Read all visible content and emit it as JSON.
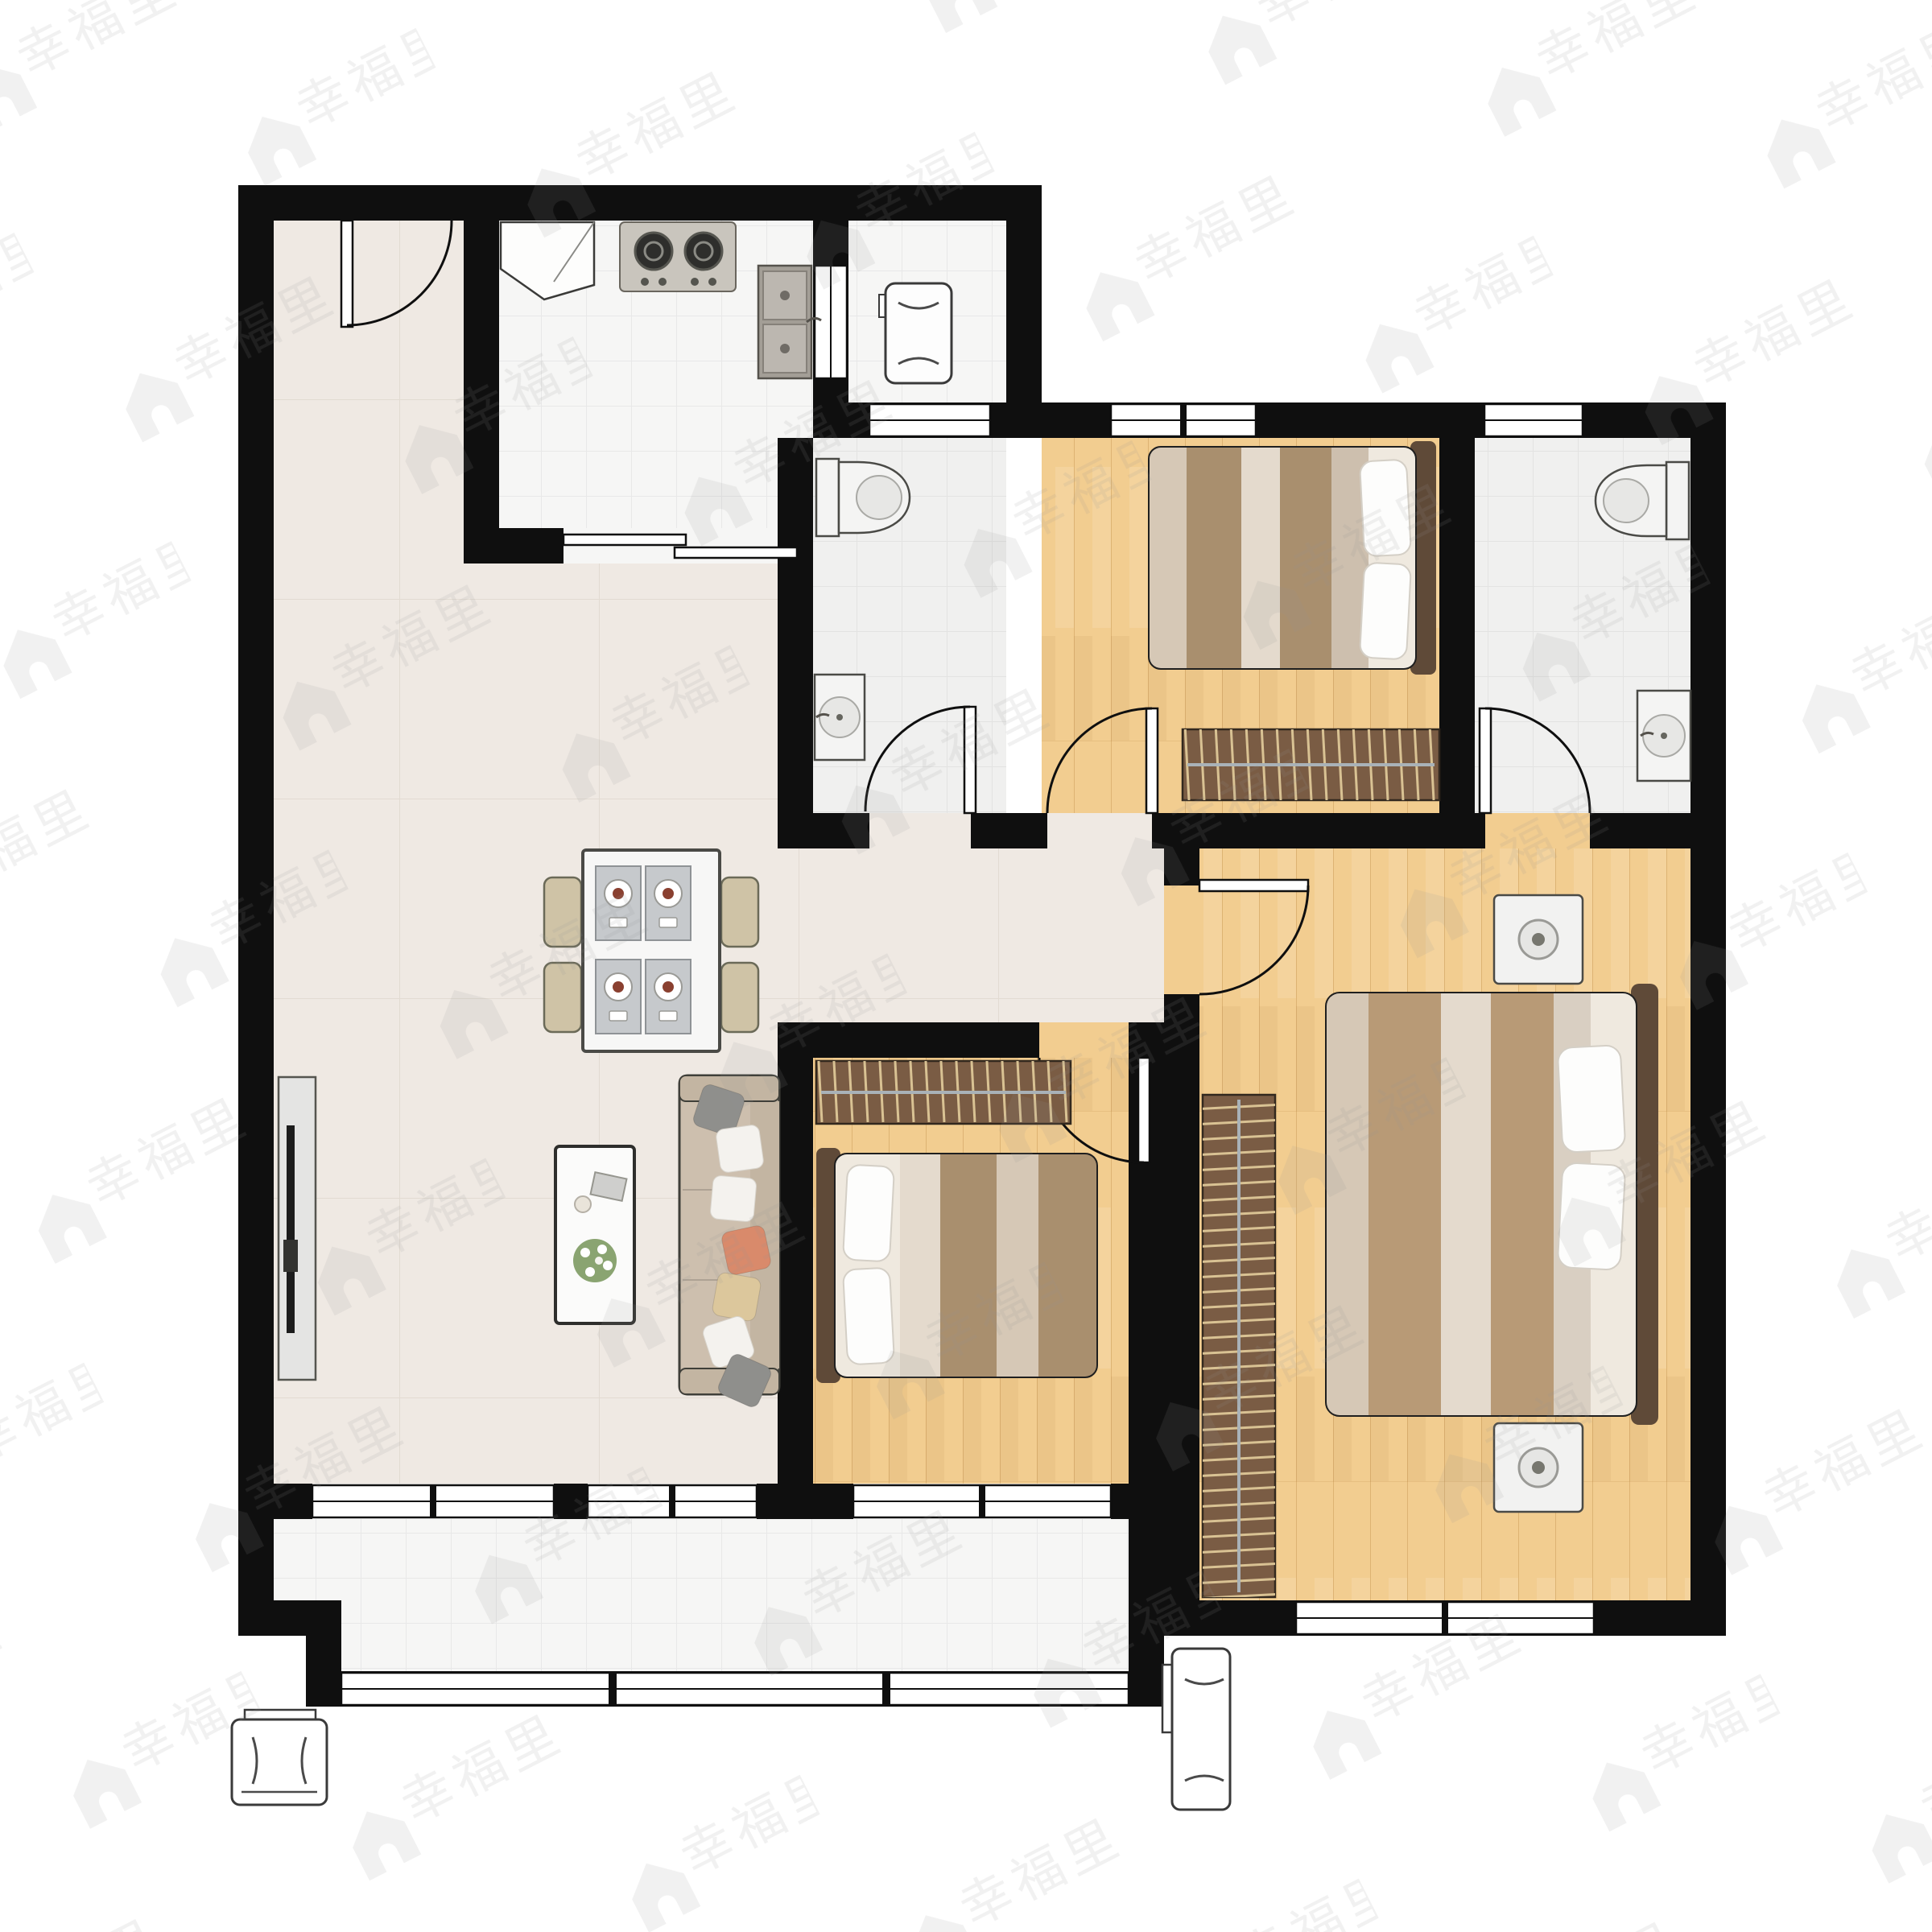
{
  "watermark": {
    "text": "幸福里",
    "icon": "house-icon"
  },
  "colors": {
    "wall": "#0f0f0f",
    "marble": "#efe9e3",
    "tile": "#f6f6f5",
    "tile_bath": "#f0f0ef",
    "wood": "#f2cd90",
    "plank_line": "#c89f5e",
    "wardrobe": "#7a5c44",
    "hanger": "#d9c7a0",
    "bed_frame": "#c9b69e",
    "headboard": "#5f4a38",
    "blanket_tan": "#a98f6e",
    "blanket_cream": "#e4dacd",
    "sofa": "#cdbfae",
    "pillow_accent": "#d98a6b",
    "pillow_tan": "#dcc79c",
    "fixture_gray": "#c9c5bd",
    "flower_green": "#8aa471",
    "watermark": "#8f8f8f"
  },
  "rooms": [
    {
      "id": "entry-foyer",
      "floor": "marble"
    },
    {
      "id": "living-dining-room",
      "floor": "marble"
    },
    {
      "id": "hallway",
      "floor": "marble"
    },
    {
      "id": "kitchen",
      "floor": "white-tile"
    },
    {
      "id": "laundry-niche",
      "floor": "white-tile"
    },
    {
      "id": "bathroom-top",
      "floor": "gray-tile"
    },
    {
      "id": "bathroom-right",
      "floor": "gray-tile"
    },
    {
      "id": "bedroom-top",
      "floor": "wood"
    },
    {
      "id": "bedroom-middle",
      "floor": "wood"
    },
    {
      "id": "master-bedroom",
      "floor": "wood"
    },
    {
      "id": "balcony",
      "floor": "white-tile"
    }
  ],
  "furniture": {
    "kitchen": [
      "corner-cabinet",
      "gas-stove-2-burner",
      "double-basin-sink",
      "sliding-door"
    ],
    "laundry-niche": [
      "washing-machine",
      "pass-window"
    ],
    "bathroom-top": [
      "toilet",
      "wash-basin",
      "swing-door"
    ],
    "bathroom-right": [
      "toilet",
      "wash-basin",
      "swing-door"
    ],
    "bedroom-top": [
      "double-bed",
      "wardrobe",
      "window",
      "swing-door"
    ],
    "bedroom-middle": [
      "double-bed",
      "wardrobe",
      "window",
      "swing-door"
    ],
    "master-bedroom": [
      "double-bed",
      "wardrobe",
      "nightstand",
      "nightstand",
      "window",
      "swing-door"
    ],
    "living-dining-room": [
      "dining-table",
      "dining-chair",
      "dining-chair",
      "dining-chair",
      "dining-chair",
      "tv-panel",
      "coffee-table",
      "flower-vase",
      "sofa",
      "entrance-door"
    ],
    "balcony": [
      "ac-outdoor-unit-left",
      "ac-outdoor-unit-right",
      "window-band"
    ]
  },
  "counts": {
    "bedrooms": 3,
    "bathrooms": 2,
    "doors": 6,
    "window_sections": 9,
    "ac_units": 2,
    "dining_chairs": 4,
    "sofa_pillows": 7
  }
}
